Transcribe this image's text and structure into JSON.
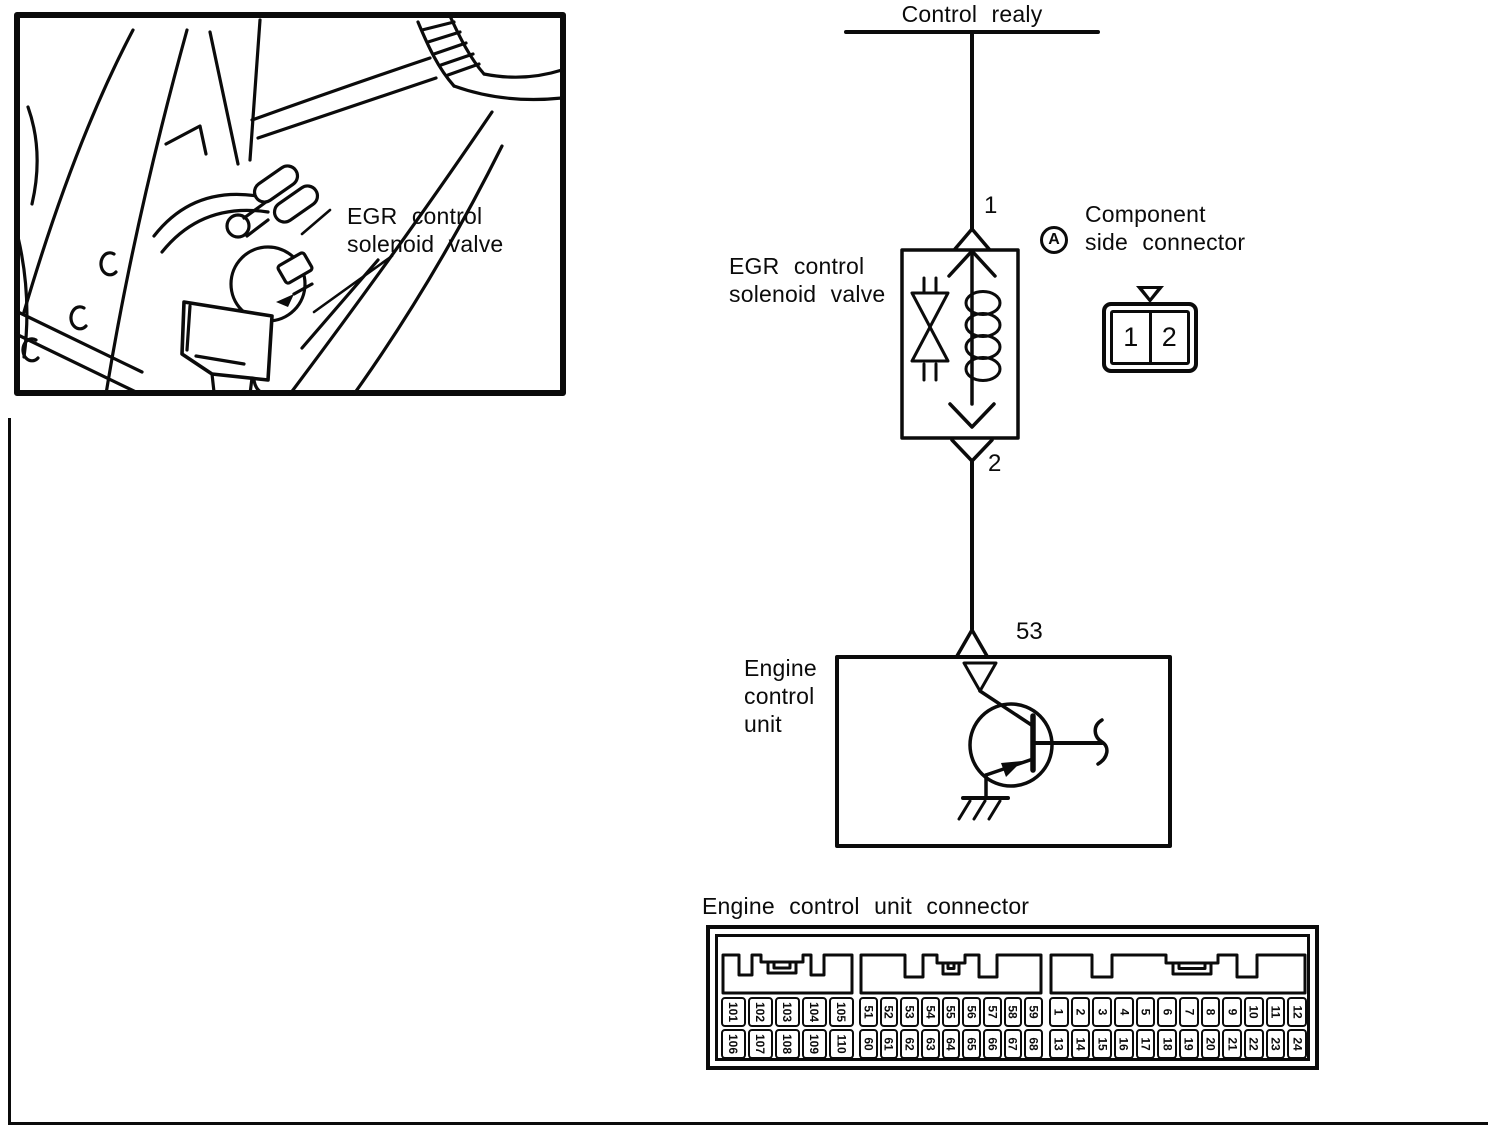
{
  "colors": {
    "ink": "#0b0b0b",
    "paper": "#ffffff"
  },
  "illustration": {
    "label_line1": "EGR control",
    "label_line2": "solenoid valve"
  },
  "schematic": {
    "relay_label": "Control realy",
    "terminal_1": "1",
    "terminal_2": "2",
    "terminal_53": "53",
    "egr_label_line1": "EGR control",
    "egr_label_line2": "solenoid valve",
    "ecu_label_line1": "Engine",
    "ecu_label_line2": "control",
    "ecu_label_line3": "unit",
    "component_connector": {
      "marker_letter": "A",
      "label_line1": "Component",
      "label_line2": "side connector",
      "pins": [
        "1",
        "2"
      ]
    }
  },
  "ecu_connector": {
    "title": "Engine control unit connector",
    "groups": [
      {
        "top": [
          "101",
          "102",
          "103",
          "104",
          "105"
        ],
        "bottom": [
          "106",
          "107",
          "108",
          "109",
          "110"
        ]
      },
      {
        "top": [
          "51",
          "52",
          "53",
          "54",
          "55",
          "56",
          "57",
          "58",
          "59"
        ],
        "bottom": [
          "60",
          "61",
          "62",
          "63",
          "64",
          "65",
          "66",
          "67",
          "68"
        ]
      },
      {
        "top": [
          "1",
          "2",
          "3",
          "4",
          "5",
          "6",
          "7",
          "8",
          "9",
          "10",
          "11",
          "12"
        ],
        "bottom": [
          "13",
          "14",
          "15",
          "16",
          "17",
          "18",
          "19",
          "20",
          "21",
          "22",
          "23",
          "24"
        ]
      }
    ]
  }
}
